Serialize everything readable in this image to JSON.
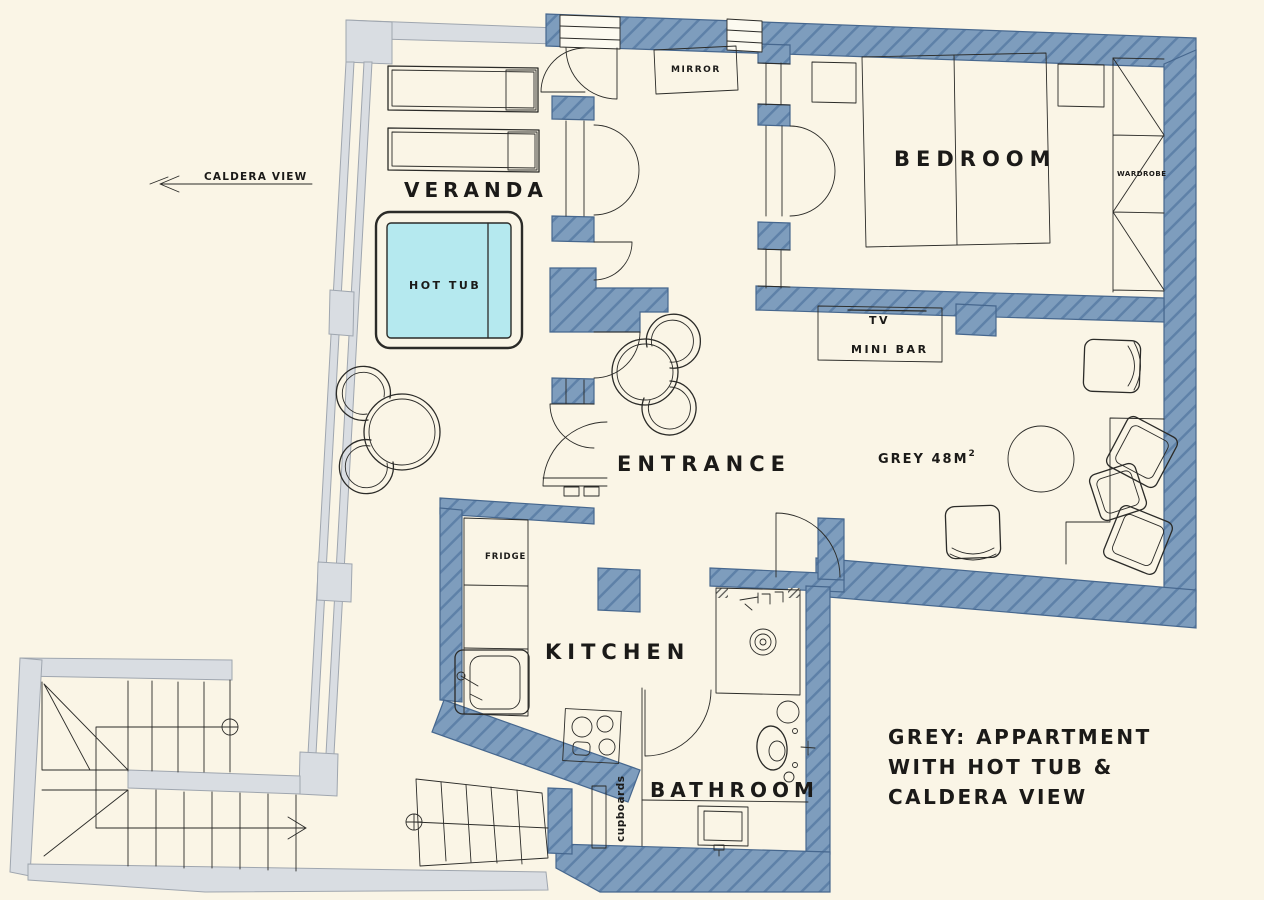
{
  "plan": {
    "labels": {
      "caldera_view": "CALDERA VIEW",
      "veranda": "VERANDA",
      "hot_tub": "HOT TUB",
      "mirror": "MIRROR",
      "bedroom": "BEDROOM",
      "wardrobe": "WARDROBE",
      "tv": "TV",
      "mini_bar": "MINI BAR",
      "entrance": "ENTRANCE",
      "area": "GREY  48M",
      "area_sup": "2",
      "fridge": "FRIDGE",
      "kitchen": "KITCHEN",
      "bathroom": "BATHROOM",
      "cupboards": "cupboards"
    },
    "legend": {
      "line1": "GREY: APPARTMENT",
      "line2": "WITH HOT TUB &",
      "line3": "CALDERA VIEW"
    },
    "colors": {
      "bg": "#FAF5E6",
      "wall": "#7E9DBD",
      "hatch": "#5E81A8",
      "outline": "#46678E",
      "grey": "#D9DDE2",
      "greyline": "#9FA6AF",
      "line": "#2B2B28",
      "hottub": "#B5E9EF",
      "text": "#1B1A18"
    }
  }
}
